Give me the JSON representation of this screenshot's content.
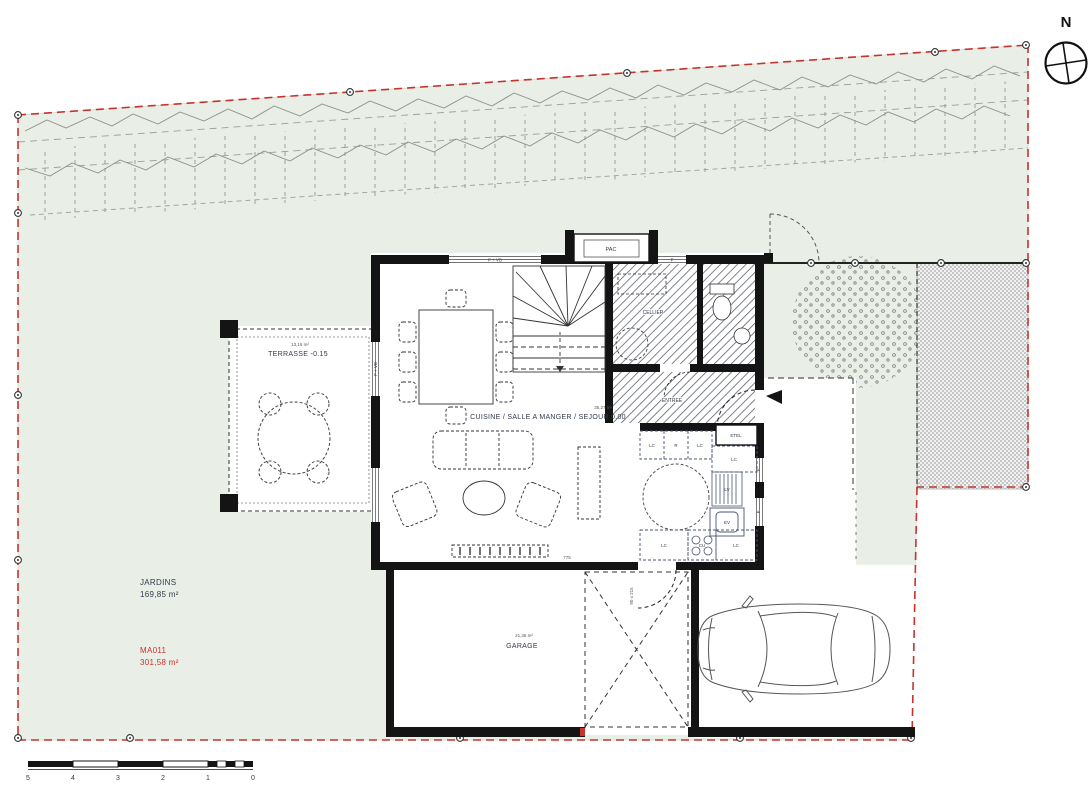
{
  "compass": {
    "north": "N"
  },
  "site": {
    "jardins": {
      "name": "JARDINS",
      "area": "169,85 m²"
    },
    "parcel": {
      "id": "MA011",
      "area": "301,58 m²"
    }
  },
  "rooms": {
    "terrasse": {
      "area": "13,16 m²",
      "name": "TERRASSE -0.15"
    },
    "sejour": {
      "area": "35,27 m²",
      "name": "CUISINE / SALLE A MANGER / SEJOUR 0.00"
    },
    "cellier": {
      "name": "CELLIER"
    },
    "entree": {
      "name": "ENTREE"
    },
    "garage": {
      "area": "21,36 m²",
      "name": "GARAGE"
    }
  },
  "equipment": {
    "pac": "PAC",
    "etel": "ETEL",
    "lc": "LC",
    "r": "R",
    "lv": "LV",
    "ev": "EV",
    "cu": "CU",
    "f": "F",
    "window": "F + VB"
  },
  "dimensions": {
    "wall": "775",
    "door": "90 x 215"
  },
  "scalebar": {
    "ticks": [
      "5",
      "4",
      "3",
      "2",
      "1",
      "0"
    ]
  },
  "colors": {
    "boundary": "#c4342c",
    "garden": "#e9eee6",
    "wall": "#141414",
    "label": "#333a4d"
  }
}
